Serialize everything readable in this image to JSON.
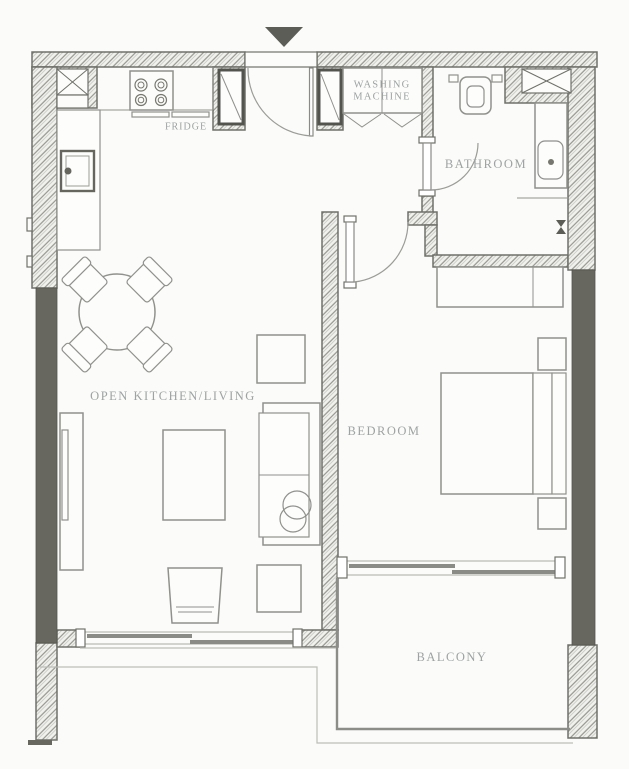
{
  "page": {
    "background": "#fbfbf9",
    "type": "apartment-floor-plan"
  },
  "colors": {
    "wall_hatch": "#96968f",
    "wall_outline": "#70706b",
    "window_fill": "#67675f",
    "arrow_fill": "#5d5d58",
    "furniture_stroke": "#90908d",
    "label_text": "#9da3a2"
  },
  "labels": {
    "fridge": "FRIDGE",
    "washing_machine": "WASHING\nMACHINE",
    "bathroom": "BATHROOM",
    "living": "OPEN KITCHEN/LIVING",
    "bedroom": "BEDROOM",
    "balcony": "BALCONY"
  },
  "icons": {
    "entrance-arrow": "▼ entry direction marker",
    "stove-icon": "4-burner cooktop circles",
    "sink-icon": "kitchen sink square with faucet dot",
    "toilet-icon": "toilet plan symbol",
    "washbasin-icon": "bathroom vanity basin",
    "sprinkler-icon": "small valve bowtie on bedroom/bathroom wall",
    "shaft-icon": "crossed-box duct shaft (x2)"
  },
  "rooms": [
    {
      "name": "open-kitchen-living"
    },
    {
      "name": "bathroom"
    },
    {
      "name": "bedroom"
    },
    {
      "name": "balcony"
    }
  ]
}
